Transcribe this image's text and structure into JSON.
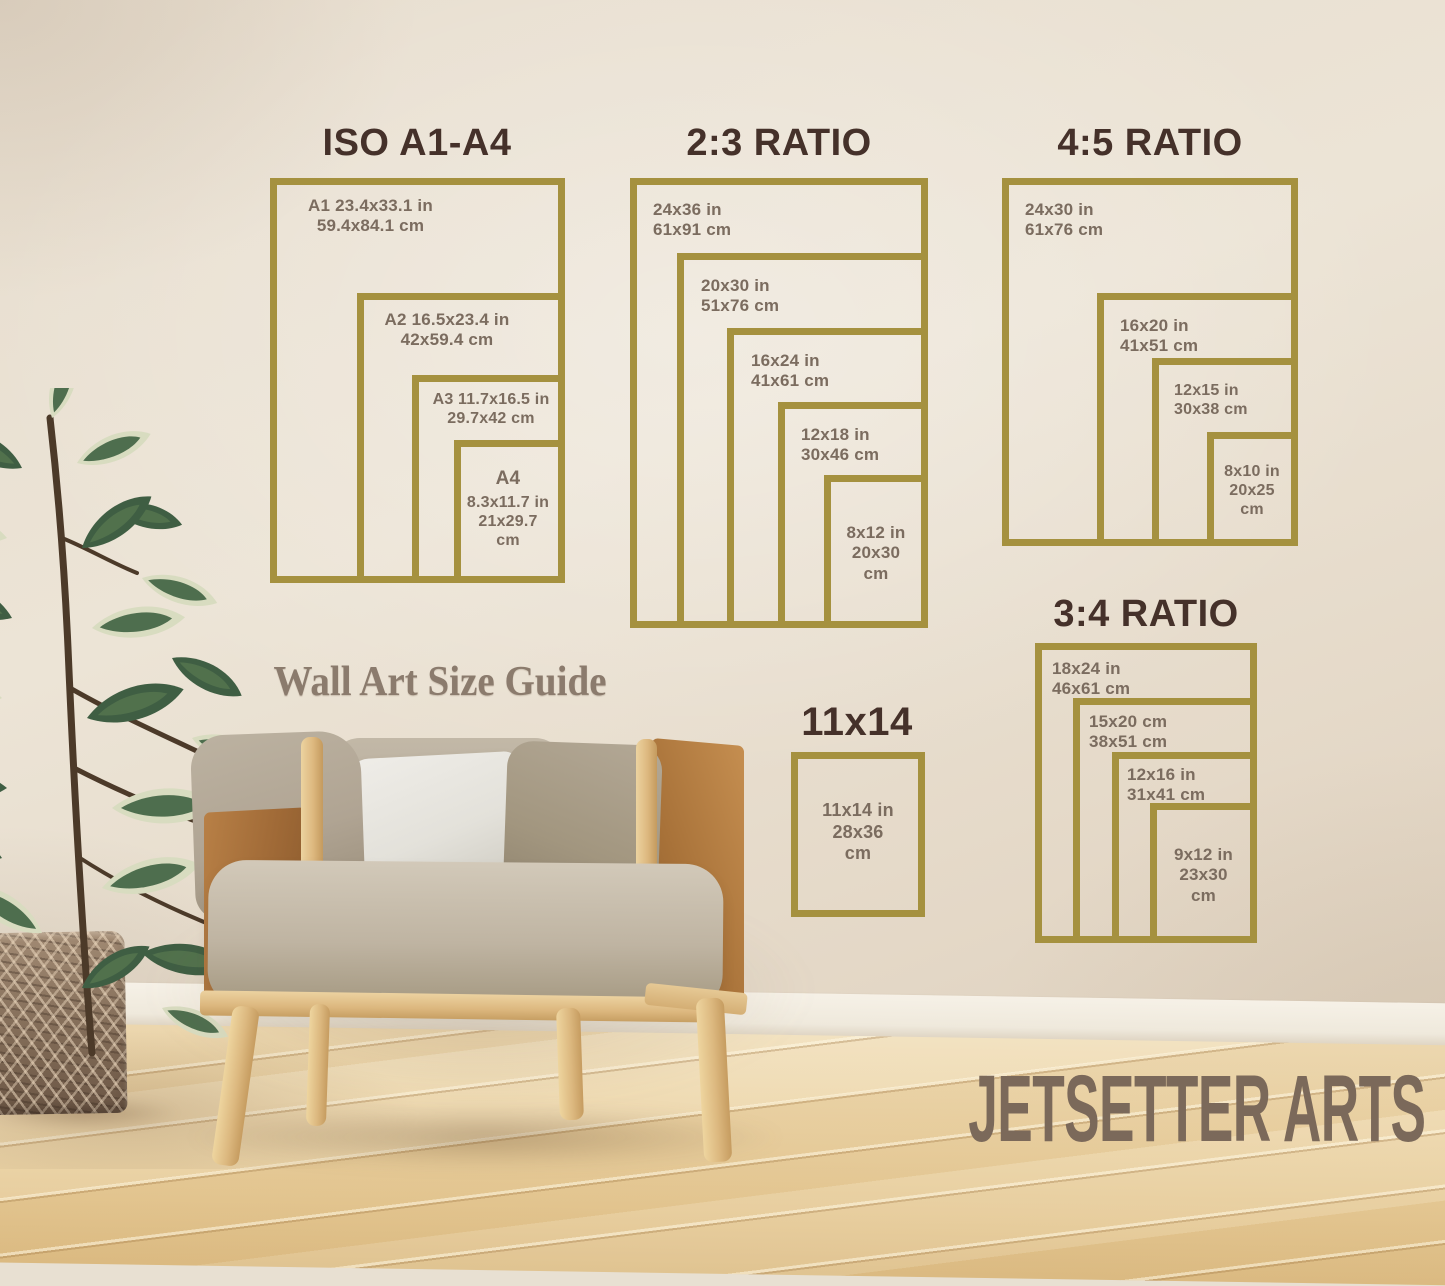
{
  "caption": "Wall Art Size Guide",
  "brand": "JETSETTER ARTS",
  "colors": {
    "frame_gold": "#a5913f",
    "heading_brown": "#45312a",
    "label_taupe": "#7b6c5f",
    "caption_text": "#8b7b6d",
    "brand_text": "#7b695a",
    "wall": "#e8e0d2",
    "floor_wood": "#ead1a4"
  },
  "sections": {
    "iso": {
      "title": "ISO A1-A4",
      "frames": {
        "a1": {
          "line1": "A1 23.4x33.1 in",
          "line2": "59.4x84.1 cm"
        },
        "a2": {
          "line1": "A2 16.5x23.4 in",
          "line2": "42x59.4 cm"
        },
        "a3": {
          "line1": "A3 11.7x16.5 in",
          "line2": "29.7x42 cm"
        },
        "a4": {
          "name": "A4",
          "line1": "8.3x11.7 in",
          "line2": "21x29.7",
          "line3": "cm"
        }
      }
    },
    "ratio23": {
      "title": "2:3 RATIO",
      "frames": {
        "s24x36": {
          "line1": "24x36 in",
          "line2": "61x91 cm"
        },
        "s20x30": {
          "line1": "20x30 in",
          "line2": "51x76 cm"
        },
        "s16x24": {
          "line1": "16x24 in",
          "line2": "41x61 cm"
        },
        "s12x18": {
          "line1": "12x18 in",
          "line2": "30x46 cm"
        },
        "s8x12": {
          "line1": "8x12 in",
          "line2": "20x30",
          "line3": "cm"
        }
      }
    },
    "ratio45": {
      "title": "4:5 RATIO",
      "frames": {
        "s24x30": {
          "line1": "24x30 in",
          "line2": "61x76 cm"
        },
        "s16x20": {
          "line1": "16x20 in",
          "line2": "41x51 cm"
        },
        "s12x15": {
          "line1": "12x15 in",
          "line2": "30x38 cm"
        },
        "s8x10": {
          "line1": "8x10 in",
          "line2": "20x25",
          "line3": "cm"
        }
      }
    },
    "ratio34": {
      "title": "3:4 RATIO",
      "frames": {
        "s18x24": {
          "line1": "18x24 in",
          "line2": "46x61 cm"
        },
        "s15x20": {
          "line1": "15x20 cm",
          "line2": "38x51 cm"
        },
        "s12x16": {
          "line1": "12x16 in",
          "line2": "31x41 cm"
        },
        "s9x12": {
          "line1": "9x12 in",
          "line2": "23x30",
          "line3": "cm"
        }
      }
    },
    "size11x14": {
      "title": "11x14",
      "frames": {
        "s11x14": {
          "line1": "11x14 in",
          "line2": "28x36",
          "line3": "cm"
        }
      }
    }
  }
}
